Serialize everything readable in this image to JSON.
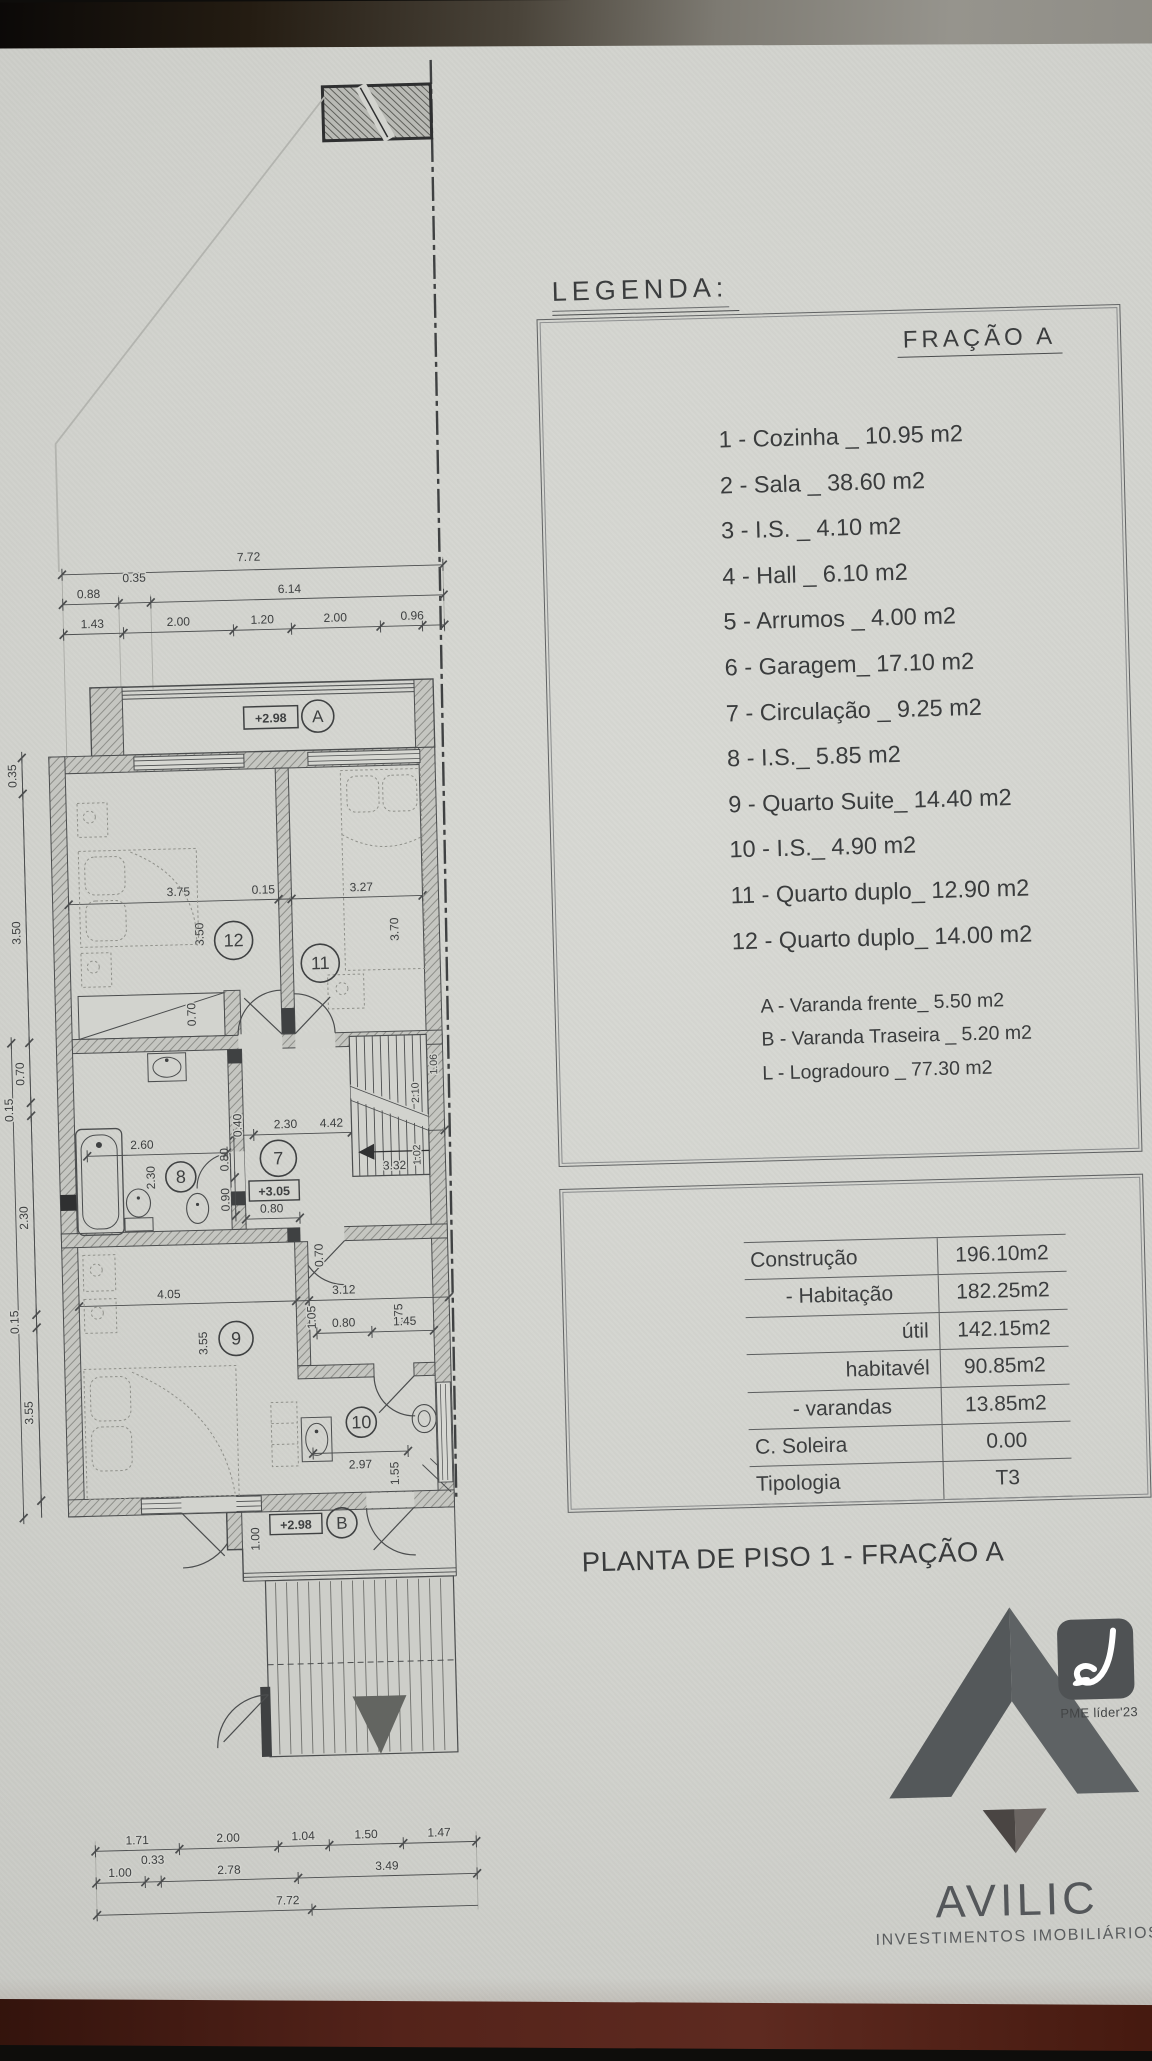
{
  "colors": {
    "paper": "#d2d3ce",
    "ink": "#3f4142",
    "wall_fill": "#c5c6c1",
    "bottom_strip": "#54231a",
    "logo_gray": "#54575a"
  },
  "legend": {
    "heading": "LEGENDA:",
    "fraction_label": "FRAÇÃO A",
    "items": [
      "1 - Cozinha _ 10.95 m2",
      "2 - Sala  _ 38.60 m2",
      "3 - I.S. _ 4.10 m2",
      "4 - Hall _ 6.10 m2",
      "5 - Arrumos _ 4.00 m2",
      "6 - Garagem_ 17.10 m2",
      "7 - Circulação _ 9.25 m2",
      "8 - I.S._ 5.85 m2",
      "9 - Quarto Suite_ 14.40 m2",
      "10 - I.S._ 4.90 m2",
      "11 - Quarto duplo_ 12.90 m2",
      "12 - Quarto duplo_ 14.00 m2"
    ],
    "sub_items": [
      "A - Varanda frente_ 5.50 m2",
      "B - Varanda Traseira _ 5.20 m2",
      "L - Logradouro _ 77.30 m2"
    ]
  },
  "areas_table": {
    "rows": [
      {
        "label": "Construção",
        "value": "196.10m2",
        "align": "left"
      },
      {
        "label": "- Habitação",
        "value": "182.25m2",
        "align": "center"
      },
      {
        "label": "útil",
        "value": "142.15m2",
        "align": "right"
      },
      {
        "label": "habitavél",
        "value": "90.85m2",
        "align": "right"
      },
      {
        "label": "- varandas",
        "value": "13.85m2",
        "align": "center"
      },
      {
        "label": "C. Soleira",
        "value": "0.00",
        "align": "left"
      },
      {
        "label": "Tipologia",
        "value": "T3",
        "align": "left"
      }
    ]
  },
  "title": "PLANTA DE PISO 1 - FRAÇÃO A",
  "logo": {
    "name": "AVILIC",
    "subtitle": "INVESTIMENTOS IMOBILIÁRIOS",
    "badge_caption": "PME líder'23"
  },
  "plan": {
    "levels": {
      "a": "+2.98",
      "mid": "+3.05",
      "b": "+2.98"
    },
    "rooms": {
      "r7": "7",
      "r8": "8",
      "r9": "9",
      "r10": "10",
      "r11": "11",
      "r12": "12"
    },
    "balconies": {
      "a": "A",
      "b": "B"
    },
    "dims": {
      "t1": "7.72",
      "t2a": "0.88",
      "t2b": "0.35",
      "t2c": "6.14",
      "t3a": "1.43",
      "t3b": "2.00",
      "t3c": "1.20",
      "t3d": "2.00",
      "t3e": "0.96",
      "l1": "0.35",
      "l2": "3.50",
      "l3": "0.70",
      "l4": "0.15",
      "l5": "2.30",
      "l6": "0.15",
      "l7": "3.55",
      "r12a": "3.75",
      "r12b": "0.15",
      "r11a": "3.27",
      "r12v": "3.50",
      "r11v": "3.70",
      "ward": "0.70",
      "b8a": "2.60",
      "b8v": "2.30",
      "c1": "0.40",
      "c2": "2.30",
      "c3": "4.42",
      "c4": "0.80",
      "c5": "0.90",
      "c6": "0.80",
      "s1": "3.32",
      "s2": "2.10",
      "s3": "1.02",
      "s4": "1.06",
      "h1": "0.70",
      "h2": "3.12",
      "h3": "1.75",
      "h4": "1.05",
      "h5": "0.80",
      "h6": "1.45",
      "r9a": "4.05",
      "r9v": "3.55",
      "b10a": "2.97",
      "b10v": "1.55",
      "bB": "1.00",
      "bot1a": "1.71",
      "bot1b": "2.00",
      "bot1c": "1.04",
      "bot1d": "1.50",
      "bot1e": "1.47",
      "bot2a": "1.00",
      "bot2b": "0.33",
      "bot2c": "2.78",
      "bot2d": "3.49",
      "bot3": "7.72"
    }
  }
}
